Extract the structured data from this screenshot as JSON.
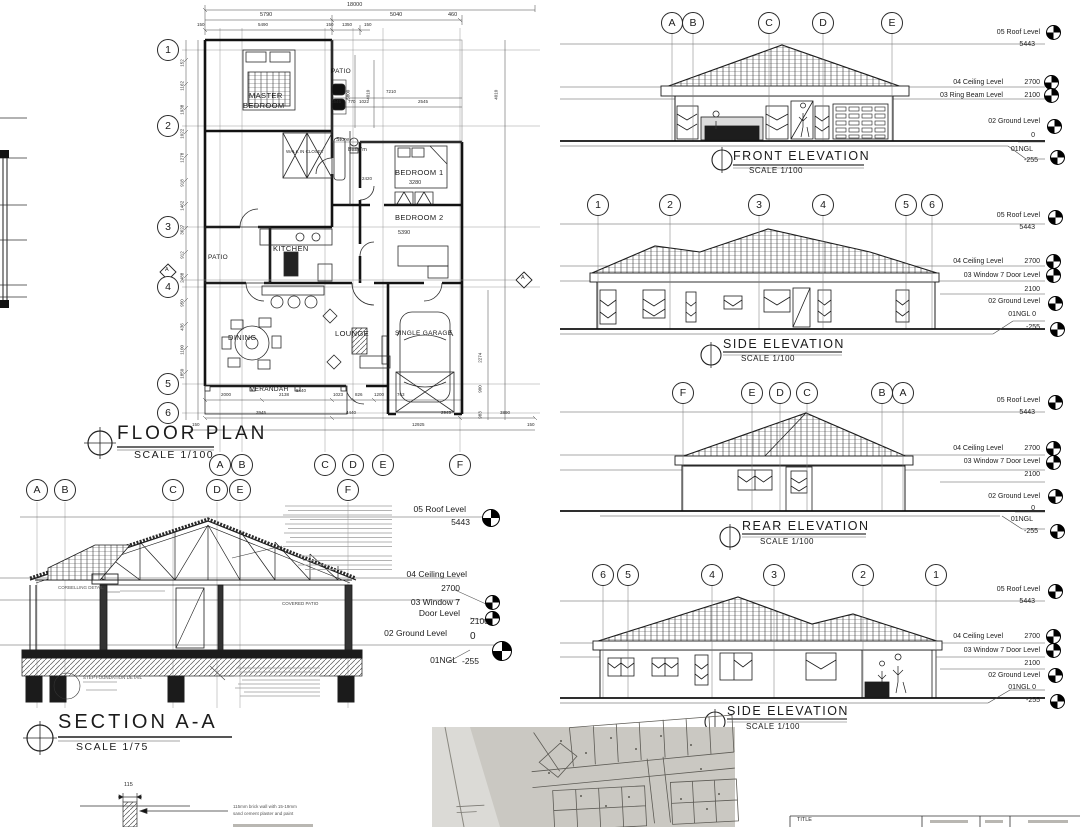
{
  "floor_plan": {
    "title": "FLOOR PLAN",
    "scale_label": "SCALE 1/100",
    "row_grids": [
      "1",
      "2",
      "3",
      "4",
      "5",
      "6"
    ],
    "col_grids": [
      "A",
      "B",
      "C",
      "D",
      "E",
      "F"
    ],
    "section_cut_label": "A",
    "rooms": {
      "master_line1": "MASTER",
      "master_line2": "BEDROOM",
      "walk_in_closet": "WALK IN CLOSET",
      "patio_top": "PATIO",
      "store": "Store",
      "bathroom": "Bathr'm",
      "bedroom1": "BEDROOM 1",
      "bedroom2": "BEDROOM 2",
      "kitchen": "KITCHEN",
      "patio_left": "PATIO",
      "dining": "DINING",
      "lounge": "LOUNGE",
      "garage": "SINGLE GARAGE",
      "verandah": "VERANDAH"
    },
    "dims": {
      "overall_top": "18000",
      "top_row1": [
        "5790",
        "5040",
        "460"
      ],
      "top_row2": [
        "150",
        "5490",
        "150",
        "1350",
        "150"
      ],
      "patio_width": "7210",
      "patio_segments": [
        "1545",
        "770",
        "1022",
        "2545"
      ],
      "bed1_width": "3280",
      "bed2_width": "5390",
      "hall_width": "2420",
      "verandah_width": "8440",
      "patio_height": "5800",
      "wing_height_l": "4010",
      "wing_height_r": "4010",
      "right_chain": [
        "2274",
        "900",
        "983"
      ],
      "left_chain": [
        "152",
        "1162",
        "1938",
        "1022",
        "1278",
        "918",
        "1462",
        "3627",
        "912",
        "2488",
        "950",
        "436",
        "1100",
        "1850"
      ],
      "bottom_row1": [
        "2000",
        "2138",
        "1023",
        "826",
        "1200",
        "763"
      ],
      "bottom_row2": [
        "3945",
        "4440",
        "2945",
        "3890"
      ],
      "bottom_overall": "12925",
      "bottom_off_l": "150",
      "bottom_off_r": "150"
    }
  },
  "elevations": [
    {
      "title": "FRONT ELEVATION",
      "scale_label": "SCALE 1/100",
      "grids": [
        "A",
        "B",
        "C",
        "D",
        "E"
      ],
      "levels": {
        "roof_label": "05 Roof Level",
        "roof_value": "5443",
        "ceiling_label": "04 Ceiling Level",
        "ceiling_value": "2700",
        "mid_label": "03 Ring Beam Level",
        "mid_value": "2100",
        "ground_label": "02 Ground Level",
        "ground_value": "0",
        "ngl_label": "01NGL",
        "ngl_value": "-255"
      }
    },
    {
      "title": "SIDE ELEVATION",
      "scale_label": "SCALE 1/100",
      "grids": [
        "1",
        "2",
        "3",
        "4",
        "5",
        "6"
      ],
      "levels": {
        "roof_label": "05 Roof Level",
        "roof_value": "5443",
        "ceiling_label": "04 Ceiling Level",
        "ceiling_value": "2700",
        "mid_label": "03 Window 7 Door Level",
        "mid_value": "2100",
        "ground_label": "02 Ground Level",
        "ground_value": "",
        "ngl_label": "01NGL 0",
        "ngl_value": "-255"
      }
    },
    {
      "title": "REAR ELEVATION",
      "scale_label": "SCALE 1/100",
      "grids": [
        "F",
        "E",
        "D",
        "C",
        "B",
        "A"
      ],
      "levels": {
        "roof_label": "05 Roof Level",
        "roof_value": "5443",
        "ceiling_label": "04 Ceiling Level",
        "ceiling_value": "2700",
        "mid_label": "03 Window 7 Door Level",
        "mid_value": "2100",
        "ground_label": "02 Ground Level",
        "ground_value": "0",
        "ngl_label": "01NGL",
        "ngl_value": "-255"
      }
    },
    {
      "title": "SIDE ELEVATION",
      "scale_label": "SCALE 1/100",
      "grids": [
        "6",
        "5",
        "4",
        "3",
        "2",
        "1"
      ],
      "levels": {
        "roof_label": "05 Roof Level",
        "roof_value": "5443",
        "ceiling_label": "04 Ceiling Level",
        "ceiling_value": "2700",
        "mid_label": "03 Window 7 Door Level",
        "mid_value": "2100",
        "ground_label": "02 Ground Level",
        "ground_value": "",
        "ngl_label": "01NGL 0",
        "ngl_value": "-255"
      }
    }
  ],
  "section": {
    "title": "SECTION A-A",
    "scale_label": "SCALE 1/75",
    "grids": [
      "A",
      "B",
      "C",
      "D",
      "E",
      "F"
    ],
    "levels": {
      "roof_label": "05 Roof Level",
      "roof_value": "5443",
      "ceiling_label": "04 Ceiling Level",
      "ceiling_value": "2700",
      "mid_label1": "03 Window 7",
      "mid_label2": "Door Level",
      "mid_value": "2100",
      "ground_label": "02 Ground Level",
      "ground_value": "0",
      "ngl_label": "01NGL",
      "ngl_value": "-255"
    },
    "covered_patio": "COVERED PATIO",
    "note_corbelling": "CORBELLING DETAIL",
    "note_foundation": "STEP FOUNDATION DETAIL"
  },
  "wall_detail": {
    "dim": "115",
    "note_line1": "115mm brick wall with 15-19mm",
    "note_line2": "sand cement plaster and paint"
  },
  "title_block": {
    "title_label": "TITLE"
  },
  "colors": {
    "ink": "#1c1c1c",
    "paper": "#ffffff",
    "photo_paper": "#cac8c2",
    "photo_line": "#56544e"
  }
}
